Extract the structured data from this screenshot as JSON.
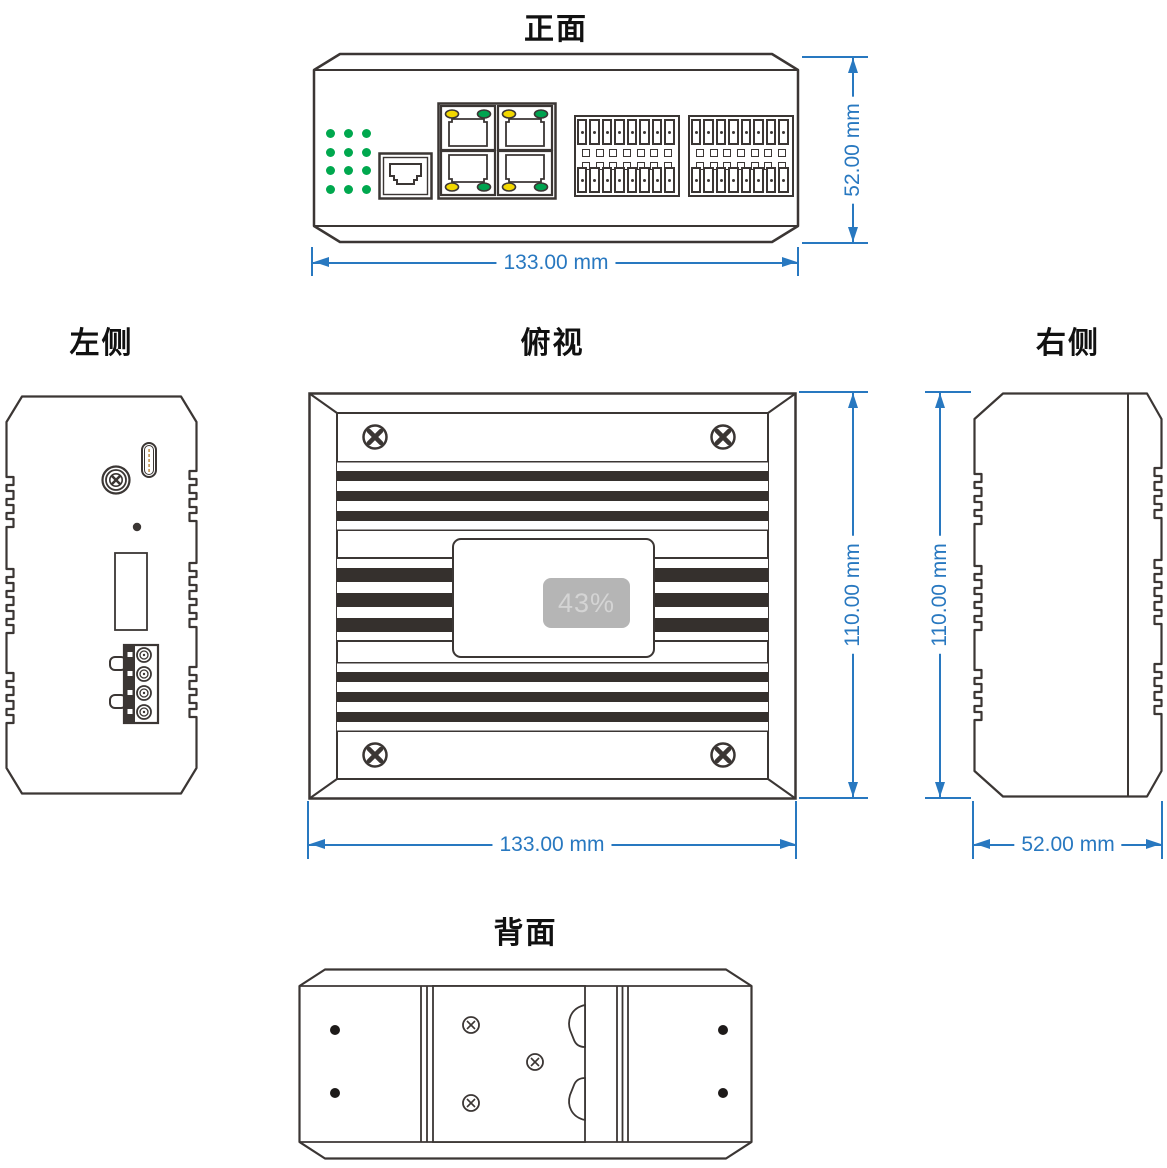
{
  "drawing": {
    "views": {
      "front": {
        "title": "正面"
      },
      "left_side": {
        "title": "左侧"
      },
      "top": {
        "title": "俯视"
      },
      "right_side": {
        "title": "右侧"
      },
      "back": {
        "title": "背面"
      }
    },
    "dimensions": {
      "front_width": "133.00 mm",
      "front_height": "52.00 mm",
      "top_width": "133.00 mm",
      "top_height": "110.00 mm",
      "right_width": "52.00 mm",
      "right_height": "110.00 mm"
    },
    "screen_overlay": {
      "battery_percent": "43%"
    }
  },
  "front_panel": {
    "led_grid": {
      "rows": 4,
      "cols": 3,
      "color": "#00a84e"
    },
    "console_port_count": 1,
    "lan_ports": {
      "count": 4,
      "led_left_color": "#f2d800",
      "led_right_color": "#00a350"
    },
    "terminal_blocks": {
      "count": 2,
      "pins_top": 8,
      "pins_bottom": 8,
      "square_rows": 2,
      "squares_per_row": 7
    }
  },
  "back_panel": {
    "mount_hole_count": 4,
    "bracket_screw_count": 3
  },
  "top_panel": {
    "corner_screw_count": 4,
    "fin_groups": 3
  },
  "colors": {
    "outline": "#3b3634",
    "fin": "#35302d",
    "dimension": "#2878c0",
    "led_green": "#00a84e",
    "led_yellow": "#f2d800",
    "usb_pin": "#c9a063",
    "overlay_bg": "#b5b5b5",
    "overlay_text": "#d4d4d4"
  }
}
